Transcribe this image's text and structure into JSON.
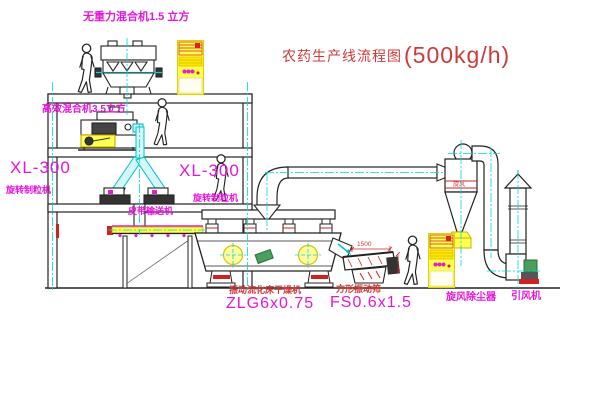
{
  "title": {
    "text": "农药生产线流程图",
    "capacity": "(500kg/h)"
  },
  "labels": {
    "weightless_mixer": "无重力混合机1.5 立方",
    "high_efficiency_mixer": "高效混合机3.5立方",
    "granulator_left": {
      "model": "XL-300",
      "name": "旋转制粒机"
    },
    "granulator_right": {
      "model": "XL-300",
      "name": "旋转制粒机"
    },
    "belt_conveyor": "皮带输送机",
    "fluid_bed_dryer": {
      "name": "振动流化床干燥机",
      "model": "ZLG6x0.75"
    },
    "square_screen": {
      "name": "方形振动筛",
      "model": "FS0.6x1.5",
      "width_dim": "1500"
    },
    "cyclone": {
      "name": "旋风除尘器",
      "band_mark": "旋风"
    },
    "induced_draft_fan": "引风机"
  },
  "colors": {
    "label_magenta": "#e516d9",
    "label_red": "#cd3a3a",
    "line_black": "#222222",
    "centerline_cyan": "#00d8d8",
    "chute_cyan_fill": "#d6f7f9",
    "cabinet_yellow": "#ffff4d",
    "motor_green": "#49a05a",
    "base_red": "#d22020",
    "background": "#ffffff"
  }
}
